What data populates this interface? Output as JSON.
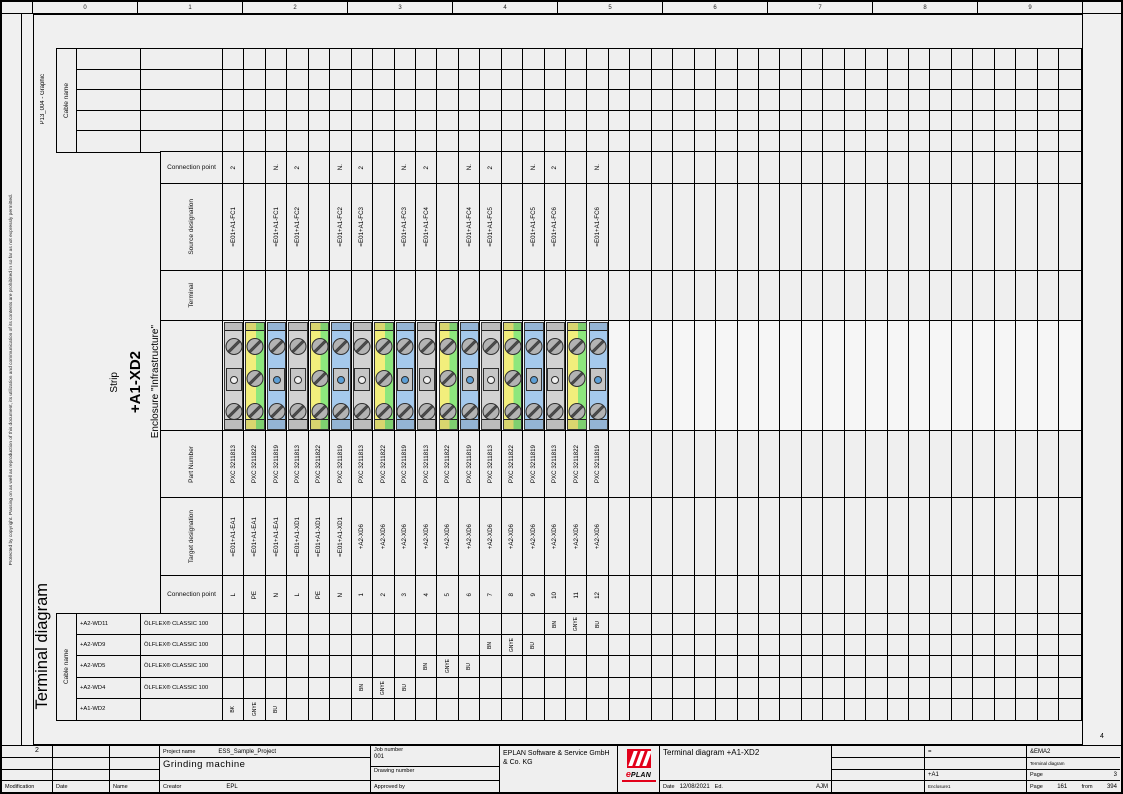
{
  "page": {
    "copyright_vertical": "Protected by copyright. Passing on as well as reproduction of this document, its utilization and communication of its contents are prohibited in so far as not expressly permitted.",
    "side_title": "Terminal diagram",
    "form_name": "P13_004 - Graphic",
    "fold_mark_left": "2",
    "fold_mark_right": "4"
  },
  "border": {
    "top_numbers": [
      "0",
      "1",
      "2",
      "3",
      "4",
      "5",
      "6",
      "7",
      "8",
      "9"
    ]
  },
  "top_cable_table": {
    "label": "Cable name",
    "rows": 5
  },
  "strip": {
    "label": "Strip",
    "name": "+A1-XD2",
    "location": "Enclosure \"Infrastructure\""
  },
  "row_labels": {
    "cp_top": "Connection point",
    "source": "Source designation",
    "terminal": "Terminal",
    "part": "Part Number",
    "target": "Target designation",
    "cp_bottom": "Connection point"
  },
  "terminals": {
    "total_columns": 40,
    "columns": [
      {
        "cp_top": "2",
        "source": "=E01+A1-FC1",
        "part": "PXC 3211813",
        "target": "=E01+A1-EA1",
        "cp_bottom": "L",
        "color": "gray"
      },
      {
        "cp_top": "",
        "source": "",
        "part": "PXC 3211822",
        "target": "=E01+A1-EA1",
        "cp_bottom": "PE",
        "color": "pe"
      },
      {
        "cp_top": "N.",
        "source": "=E01+A1-FC1",
        "part": "PXC 3211819",
        "target": "=E01+A1-EA1",
        "cp_bottom": "N",
        "color": "blue"
      },
      {
        "cp_top": "2",
        "source": "=E01+A1-FC2",
        "part": "PXC 3211813",
        "target": "=E01+A1-XD1",
        "cp_bottom": "L",
        "color": "gray"
      },
      {
        "cp_top": "",
        "source": "",
        "part": "PXC 3211822",
        "target": "=E01+A1-XD1",
        "cp_bottom": "PE",
        "color": "pe"
      },
      {
        "cp_top": "N.",
        "source": "=E01+A1-FC2",
        "part": "PXC 3211819",
        "target": "=E01+A1-XD1",
        "cp_bottom": "N",
        "color": "blue"
      },
      {
        "cp_top": "2",
        "source": "=E01+A1-FC3",
        "part": "PXC 3211813",
        "target": "+A2-XD6",
        "cp_bottom": "1",
        "color": "gray"
      },
      {
        "cp_top": "",
        "source": "",
        "part": "PXC 3211822",
        "target": "+A2-XD6",
        "cp_bottom": "2",
        "color": "pe"
      },
      {
        "cp_top": "N.",
        "source": "=E01+A1-FC3",
        "part": "PXC 3211819",
        "target": "+A2-XD6",
        "cp_bottom": "3",
        "color": "blue"
      },
      {
        "cp_top": "2",
        "source": "=E01+A1-FC4",
        "part": "PXC 3211813",
        "target": "+A2-XD6",
        "cp_bottom": "4",
        "color": "gray"
      },
      {
        "cp_top": "",
        "source": "",
        "part": "PXC 3211822",
        "target": "+A2-XD6",
        "cp_bottom": "5",
        "color": "pe"
      },
      {
        "cp_top": "N.",
        "source": "=E01+A1-FC4",
        "part": "PXC 3211819",
        "target": "+A2-XD6",
        "cp_bottom": "6",
        "color": "blue"
      },
      {
        "cp_top": "2",
        "source": "=E01+A1-FC5",
        "part": "PXC 3211813",
        "target": "+A2-XD6",
        "cp_bottom": "7",
        "color": "gray"
      },
      {
        "cp_top": "",
        "source": "",
        "part": "PXC 3211822",
        "target": "+A2-XD6",
        "cp_bottom": "8",
        "color": "pe"
      },
      {
        "cp_top": "N.",
        "source": "=E01+A1-FC5",
        "part": "PXC 3211819",
        "target": "+A2-XD6",
        "cp_bottom": "9",
        "color": "blue"
      },
      {
        "cp_top": "2",
        "source": "=E01+A1-FC6",
        "part": "PXC 3211813",
        "target": "+A2-XD6",
        "cp_bottom": "10",
        "color": "gray"
      },
      {
        "cp_top": "",
        "source": "",
        "part": "PXC 3211822",
        "target": "+A2-XD6",
        "cp_bottom": "11",
        "color": "pe"
      },
      {
        "cp_top": "N.",
        "source": "=E01+A1-FC6",
        "part": "PXC 3211819",
        "target": "+A2-XD6",
        "cp_bottom": "12",
        "color": "blue"
      }
    ]
  },
  "cables": {
    "label": "Cable name",
    "rows": [
      {
        "name": "+A2-WD11",
        "type": "ÖLFLEX® CLASSIC 100",
        "wires": [
          {
            "col": 16,
            "code": "BN"
          },
          {
            "col": 17,
            "code": "GNYE"
          },
          {
            "col": 18,
            "code": "BU"
          }
        ]
      },
      {
        "name": "+A2-WD9",
        "type": "ÖLFLEX® CLASSIC 100",
        "wires": [
          {
            "col": 13,
            "code": "BN"
          },
          {
            "col": 14,
            "code": "GNYE"
          },
          {
            "col": 15,
            "code": "BU"
          }
        ]
      },
      {
        "name": "+A2-WD5",
        "type": "ÖLFLEX® CLASSIC 100",
        "wires": [
          {
            "col": 10,
            "code": "BN"
          },
          {
            "col": 11,
            "code": "GNYE"
          },
          {
            "col": 12,
            "code": "BU"
          }
        ]
      },
      {
        "name": "+A2-WD4",
        "type": "ÖLFLEX® CLASSIC 100",
        "wires": [
          {
            "col": 7,
            "code": "BN"
          },
          {
            "col": 8,
            "code": "GNYE"
          },
          {
            "col": 9,
            "code": "BU"
          }
        ]
      },
      {
        "name": "+A1-WD2",
        "type": "",
        "wires": [
          {
            "col": 1,
            "code": "BK"
          },
          {
            "col": 2,
            "code": "GNYE"
          },
          {
            "col": 3,
            "code": "BU"
          }
        ]
      }
    ]
  },
  "titleblock": {
    "modification_label": "Modification",
    "date_col_label": "Date",
    "name_col_label": "Name",
    "project_name_label": "Project name",
    "project_name": "ESS_Sample_Project",
    "machine": "Grinding machine",
    "creator_label": "Creator",
    "creator": "EPL",
    "job_number_label": "Job number",
    "job_number": "001",
    "drawing_number_label": "Drawing number",
    "approved_by_label": "Approved by",
    "company": "EPLAN Software & Service GmbH & Co. KG",
    "logo_e": "e",
    "logo_plan": "PLAN",
    "doc_title": "Terminal diagram  +A1-XD2",
    "date_label": "Date",
    "date": "12/08/2021",
    "ed_label": "Ed.",
    "ed_value": "AJM",
    "eq": "=",
    "plant": "&EMA2",
    "doc_type_small": "Terminal diagram",
    "location": "+A1",
    "location_desc": "Enclosure1",
    "page_label": "Page",
    "page_value": "3",
    "page_of_label": "Page",
    "page_number": "161",
    "from_label": "from",
    "page_total": "394"
  }
}
